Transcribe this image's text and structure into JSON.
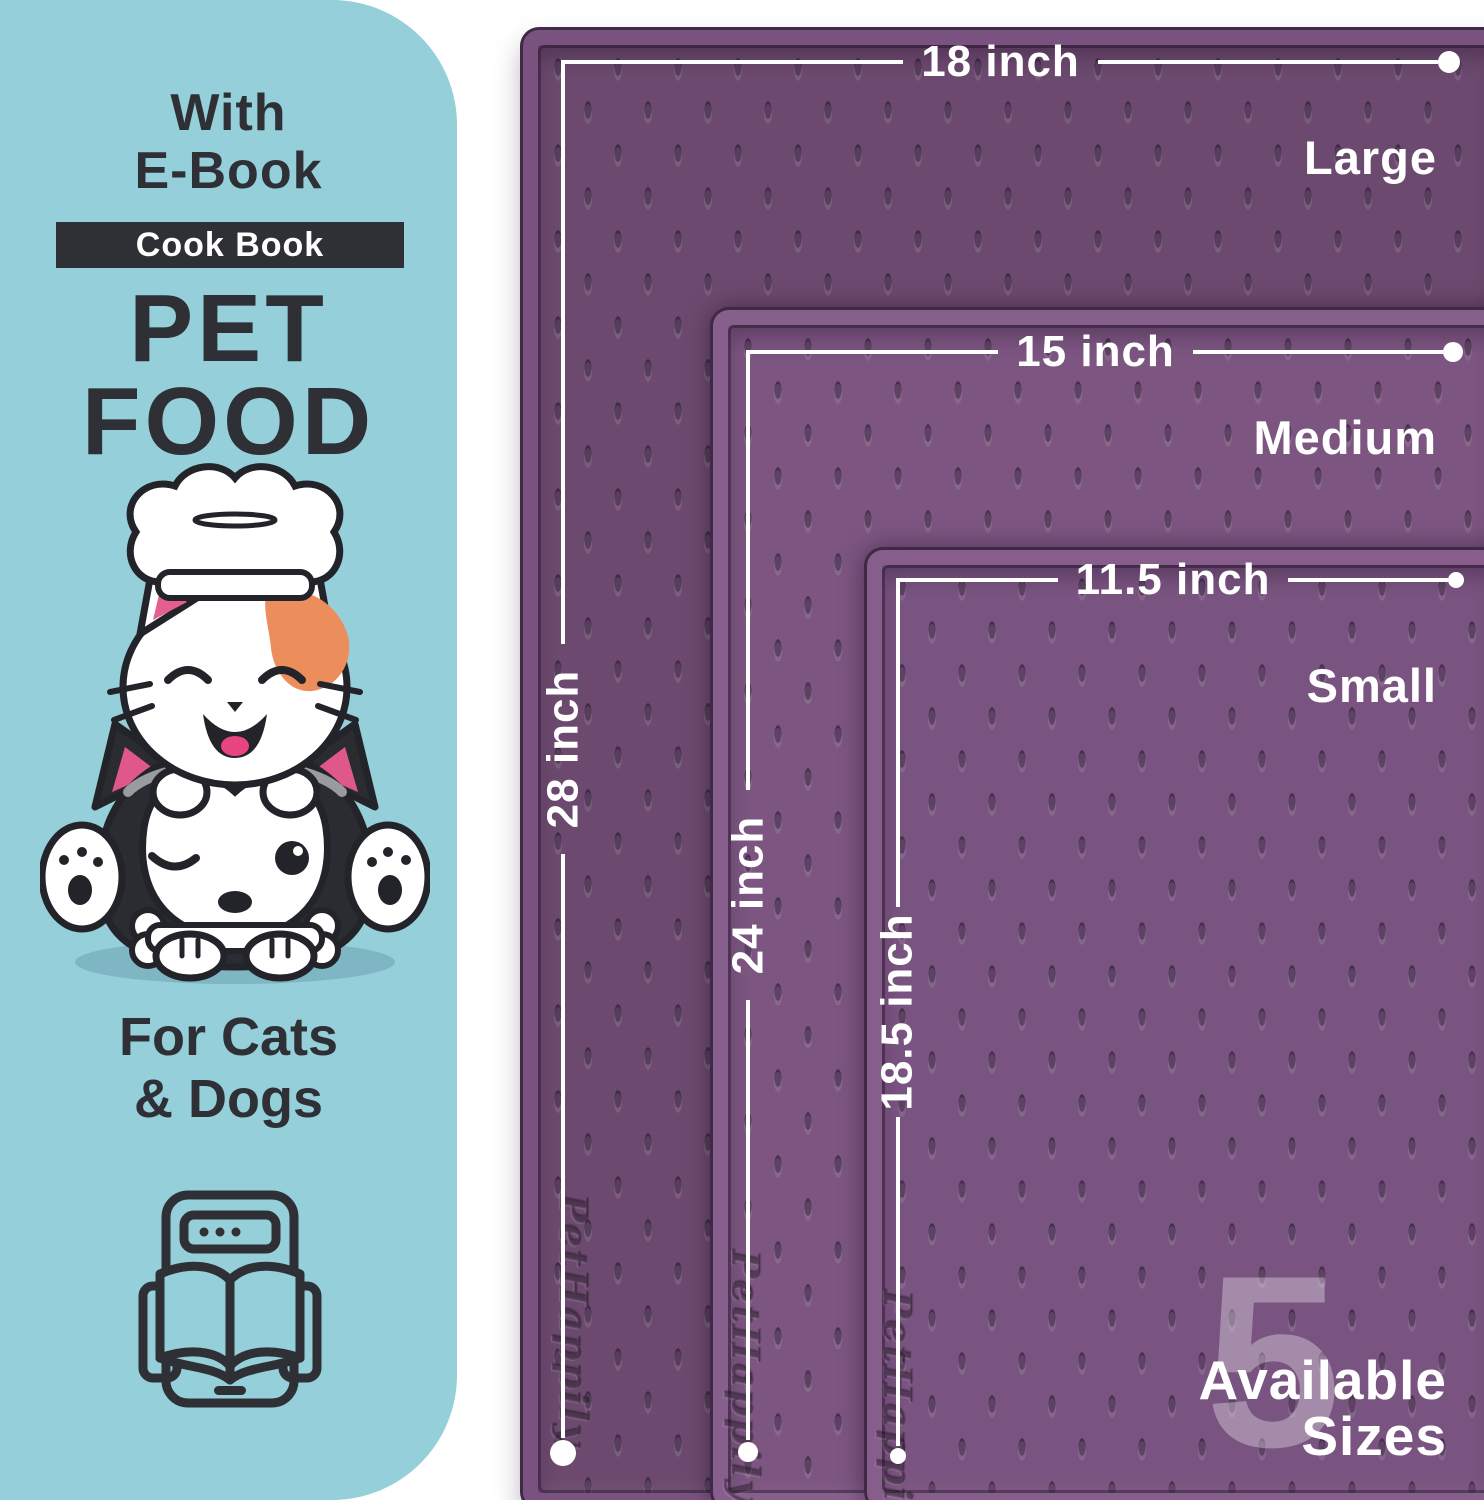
{
  "panel": {
    "eyebrow_line1": "With",
    "eyebrow_line2": "E-Book",
    "badge_label": "Cook Book",
    "title_line1": "PET",
    "title_line2": "FOOD",
    "subtitle_line1": "For Cats",
    "subtitle_line2": "& Dogs",
    "illustration": "cat-chef-on-husky-with-bone",
    "ebook_icon": "tablet-open-book",
    "colors": {
      "background": "#95cfd9",
      "text": "#2e3036",
      "badge_bg": "#2e3036",
      "badge_text": "#ffffff"
    }
  },
  "mats": {
    "brand_embossed": "PetHappily",
    "large": {
      "size_label": "Large",
      "width_label": "18 inch",
      "length_label": "28 inch",
      "face_color": "#6c4a6f",
      "rim_color": "#7a5280"
    },
    "medium": {
      "size_label": "Medium",
      "width_label": "15 inch",
      "length_label": "24 inch",
      "face_color": "#7c5681",
      "rim_color": "#875f8d"
    },
    "small": {
      "size_label": "Small",
      "width_label": "11.5 inch",
      "length_label": "18.5 inch",
      "face_color": "#7a5480",
      "rim_color": "#865d8b"
    }
  },
  "sizes_badge": {
    "number": "5",
    "line1": "Available",
    "line2": "Sizes",
    "number_color": "rgba(255,255,255,0.32)",
    "text_color": "#ffffff"
  },
  "measure": {
    "line_color": "#ffffff",
    "label_color": "#ffffff"
  }
}
